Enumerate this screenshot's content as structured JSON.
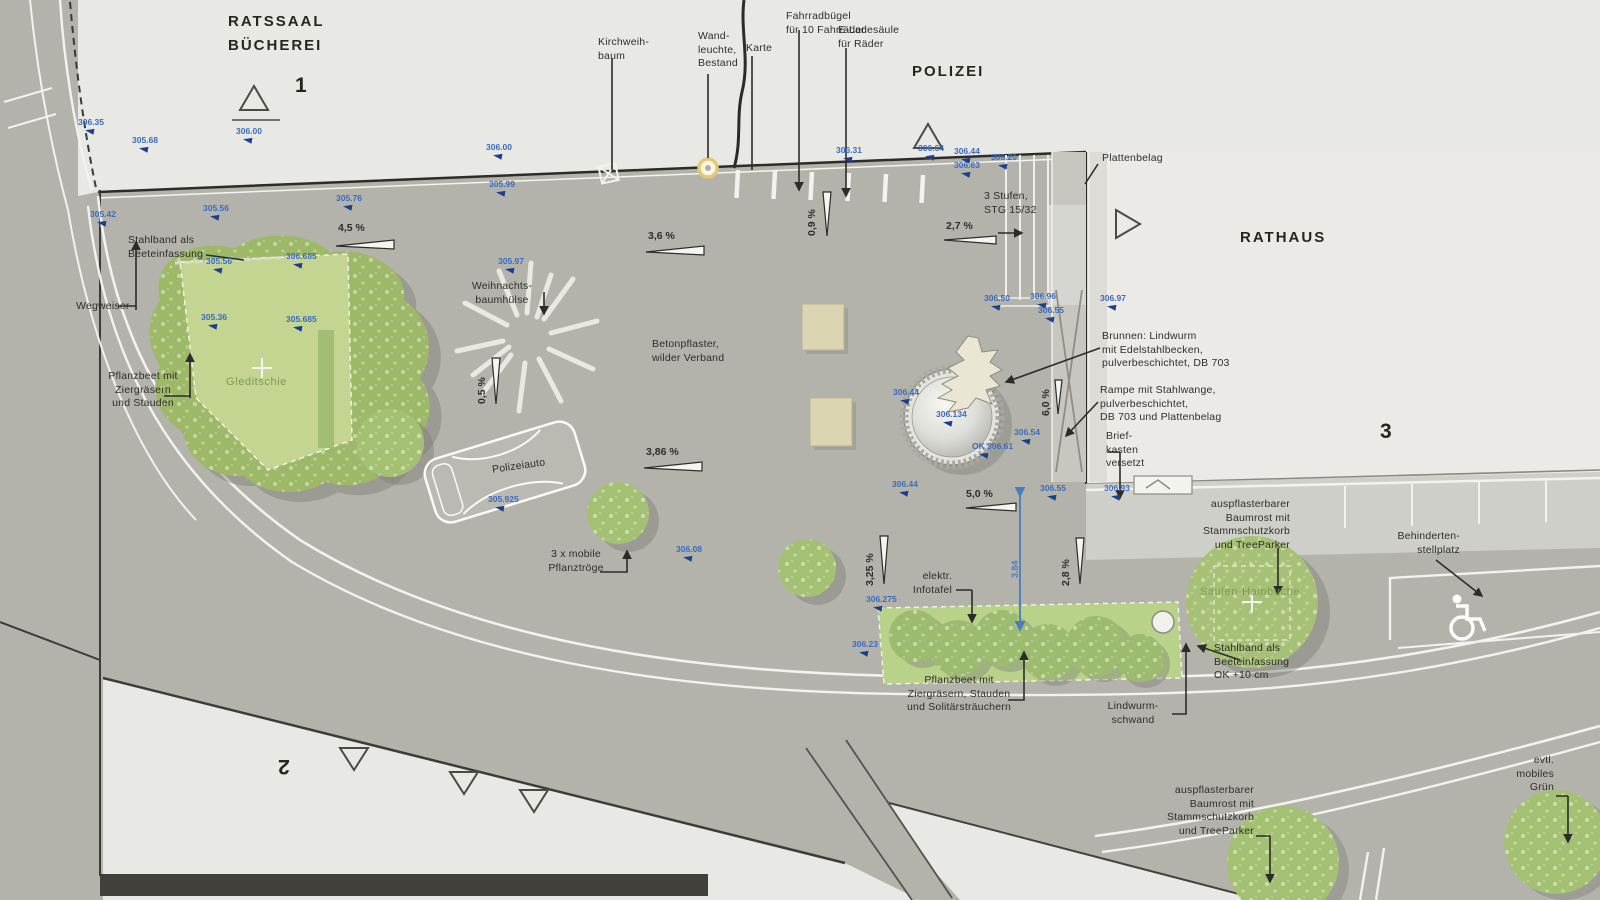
{
  "buildings": {
    "b1a": "RATSSAAL",
    "b1b": "BÜCHEREI",
    "n1": "1",
    "polizei": "POLIZEI",
    "rathaus": "RATHAUS",
    "n3": "3",
    "n2": "2"
  },
  "trees": {
    "gleditschie": "Gleditschie",
    "hainbuche": "Säulen-Hainbuche"
  },
  "ann": {
    "kirchweihbaum": {
      "l1": "Kirchweih-",
      "l2": "baum"
    },
    "wandleuchte": {
      "l1": "Wand-",
      "l2": "leuchte,",
      "l3": "Bestand"
    },
    "karte": {
      "l1": "Karte"
    },
    "fahrrad": {
      "l1": "Fahrradbügel",
      "l2": "für 10 Fahrräder"
    },
    "elade": {
      "l1": "E-Ladesäule",
      "l2": "für Räder"
    },
    "platten": {
      "l1": "Plattenbelag"
    },
    "stufen": {
      "l1": "3 Stufen,",
      "l2": "STG 15/32"
    },
    "stahlband1": {
      "l1": "Stahlband als",
      "l2": "Beeteinfassung"
    },
    "wegweiser": {
      "l1": "Wegweiser"
    },
    "pflanzbeet1": {
      "l1": "Pflanzbeet mit",
      "l2": "Ziergräsern",
      "l3": "und Stauden"
    },
    "weihnacht": {
      "l1": "Weihnachts-",
      "l2": "baumhülse"
    },
    "beton": {
      "l1": "Betonpflaster,",
      "l2": "wilder Verband"
    },
    "brunnen": {
      "l1": "Brunnen: Lindwurm",
      "l2": "mit Edelstahlbecken,",
      "l3": "pulverbeschichtet, DB 703"
    },
    "rampe": {
      "l1": "Rampe mit Stahlwange,",
      "l2": "pulverbeschichtet,",
      "l3": "DB 703 und Plattenbelag"
    },
    "brief": {
      "l1": "Brief-",
      "l2": "kasten",
      "l3": "versetzt"
    },
    "baumrost1": {
      "l1": "auspflasterbarer",
      "l2": "Baumrost mit",
      "l3": "Stammschutzkorb",
      "l4": "und TreeParker"
    },
    "behinderte": {
      "l1": "Behinderten-",
      "l2": "stellplatz"
    },
    "troege": {
      "l1": "3 x mobile",
      "l2": "Pflanztröge"
    },
    "infotafel": {
      "l1": "elektr.",
      "l2": "Infotafel"
    },
    "pflanzbeet2": {
      "l1": "Pflanzbeet mit",
      "l2": "Ziergräsern, Stauden",
      "l3": "und Solitärsträuchern"
    },
    "lindwurm": {
      "l1": "Lindwurm-",
      "l2": "schwand"
    },
    "stahlband2": {
      "l1": "Stahlband als",
      "l2": "Beeteinfassung",
      "l3": "OK +10 cm"
    },
    "baumrost2": {
      "l1": "auspflasterbarer",
      "l2": "Baumrost mit",
      "l3": "Stammschutzkorb",
      "l4": "und TreeParker"
    },
    "gruen": {
      "l1": "evtl.",
      "l2": "mobiles",
      "l3": "Grün"
    },
    "polizeiauto": {
      "l1": "Polizeiauto"
    }
  },
  "slopes": {
    "s1": "4,5 %",
    "s2": "3,6 %",
    "s3": "0,9 %",
    "s4": "2,7 %",
    "s5": "0,5 %",
    "s6": "3,86 %",
    "s7": "5,0 %",
    "s8": "3,25 %",
    "s9": "2,8 %",
    "s10": "6,0 %"
  },
  "elev": {
    "e1": "306.35",
    "e2": "305.68",
    "e3": "306.00",
    "e4": "305.76",
    "e5": "306.00",
    "e6": "305.99",
    "e7": "305.42",
    "e8": "305.56",
    "e9": "305.56",
    "e10": "306.685",
    "e11": "305.36",
    "e12": "305.685",
    "e13": "305.97",
    "e14": "306.31",
    "e15": "306.64",
    "e16": "306.44",
    "e17": "306.63",
    "e18": "306.20",
    "e19": "306.50",
    "e20": "306.96",
    "e21": "306.55",
    "e22": "306.97",
    "e23": "306.44",
    "e24": "306.134",
    "e25": "306.54",
    "e26": "OK 306.61",
    "e27": "306.44",
    "e28": "306.55",
    "e29": "306.93",
    "e30": "305.925",
    "e31": "306.08",
    "e32": "306.275",
    "e33": "306.23"
  },
  "dim": {
    "d1": "3.84"
  },
  "colors": {
    "plaza": "#b3b3ab",
    "building": "#e8e8e5",
    "green_canopy": "#9db968",
    "green_bed": "#c6d593",
    "elev_blue": "#3a6cc0",
    "bench_beige": "#dcd5b2"
  }
}
